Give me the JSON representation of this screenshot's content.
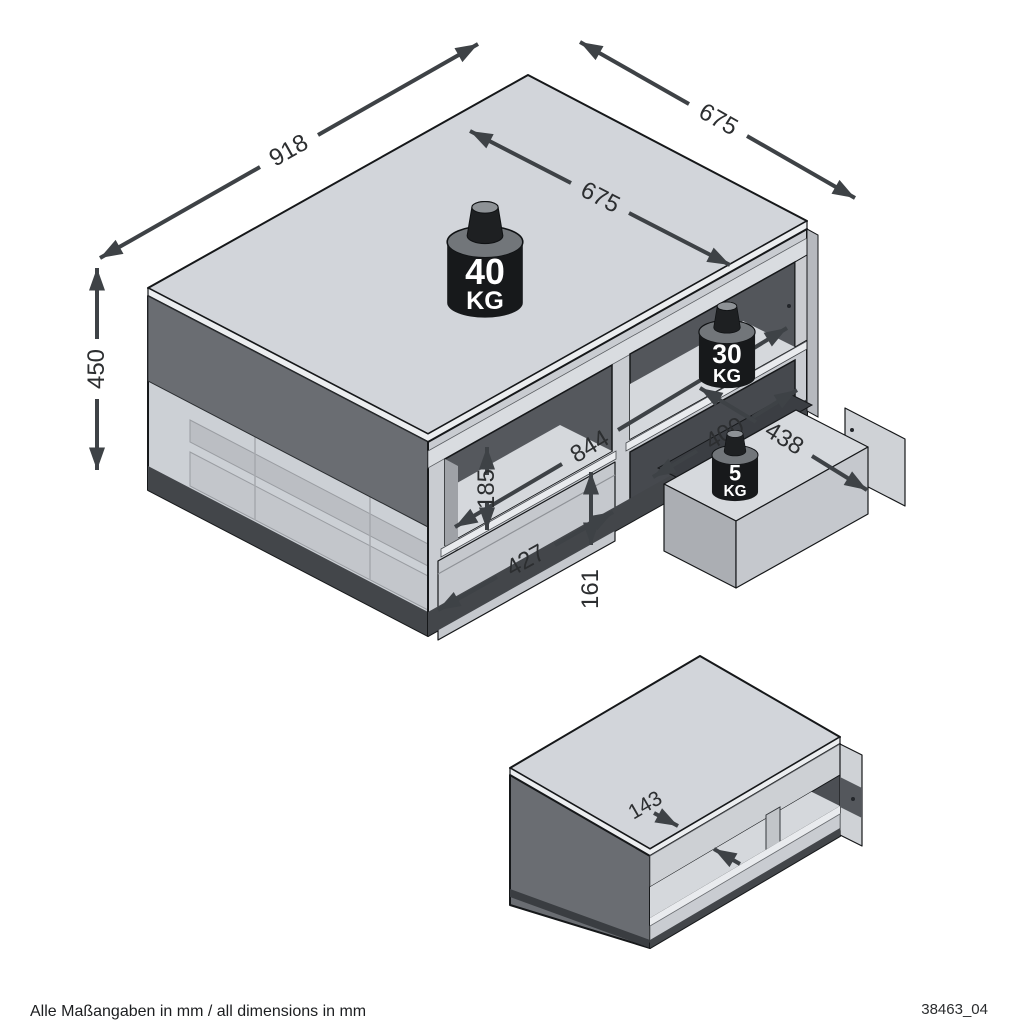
{
  "page": {
    "background": "#ffffff",
    "width": 1024,
    "height": 1024
  },
  "drawing": {
    "type": "furniture-dimension-diagram",
    "views": [
      "main-isometric-view",
      "secondary-isometric-view"
    ]
  },
  "dimensions": {
    "top_width": "918",
    "top_depth": "675",
    "top_surface_depth": "675",
    "height": "450",
    "inner_width": "844",
    "niche_height": "185",
    "drawer_front_width": "427",
    "drawer_front_height": "161",
    "drawer_inner_width": "400",
    "drawer_depth": "438",
    "shelf_opening_height": "143"
  },
  "weights": {
    "tabletop": {
      "value": "40",
      "unit": "KG"
    },
    "shelf": {
      "value": "30",
      "unit": "KG"
    },
    "drawer": {
      "value": "5",
      "unit": "KG"
    }
  },
  "footer": {
    "left": "Alle Maßangaben in mm / all dimensions in mm",
    "right": "38463_04"
  },
  "colors": {
    "table_top": "#d2d5da",
    "side_panel": "#6a6d72",
    "front_panel": "#c9ccd1",
    "dimension": "#3e4246",
    "weight_body": "#17191b"
  }
}
